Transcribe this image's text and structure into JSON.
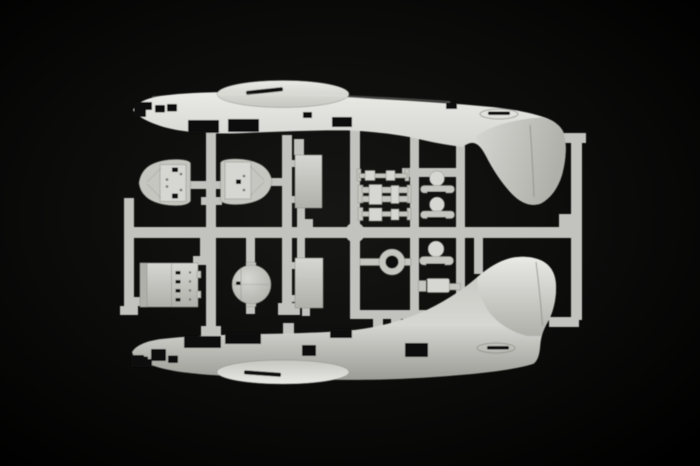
{
  "scene": {
    "description": "Photograph of an injection-moulded model-kit sprue: two flying-boat fuselage halves (noses left, tail fins facing each other) plus small detail parts held in a runner frame, light grey plastic on a black background",
    "background_label": "black studio backdrop"
  },
  "colors": {
    "background": "#000000",
    "glow": "#161614",
    "bright": "#e9e9e5",
    "light": "#d6d6d2",
    "mid": "#c6c6c0",
    "runner": "#c2c2be",
    "dim": "#b0b0aa",
    "dark": "#9c9c96",
    "edge": "#8c8c86",
    "detail": "#6e6e68",
    "black": "#0b0b0a"
  },
  "parts": {
    "fuselage_top": "upper fuselage half, nose left, tail fin pointing down",
    "fuselage_bottom": "lower fuselage half, nose left, tail fin pointing up",
    "hull_section_left": "bow hull detail part",
    "hull_section_right": "mirrored bow hull detail part",
    "floor_panel_top": "rectangular floor panel",
    "floor_panel_bottom": "rectangular floor panel",
    "bulkhead_panel": "riveted bulkhead panel",
    "disc": "circular bulkhead disc",
    "strut_row": "landing gear struts and axles",
    "gun_mounts": "dome shaped mount parts",
    "ring": "mounting ring",
    "cylinder": "stepped cylinder part",
    "sprue_frame": "runner frame of the sprue"
  }
}
